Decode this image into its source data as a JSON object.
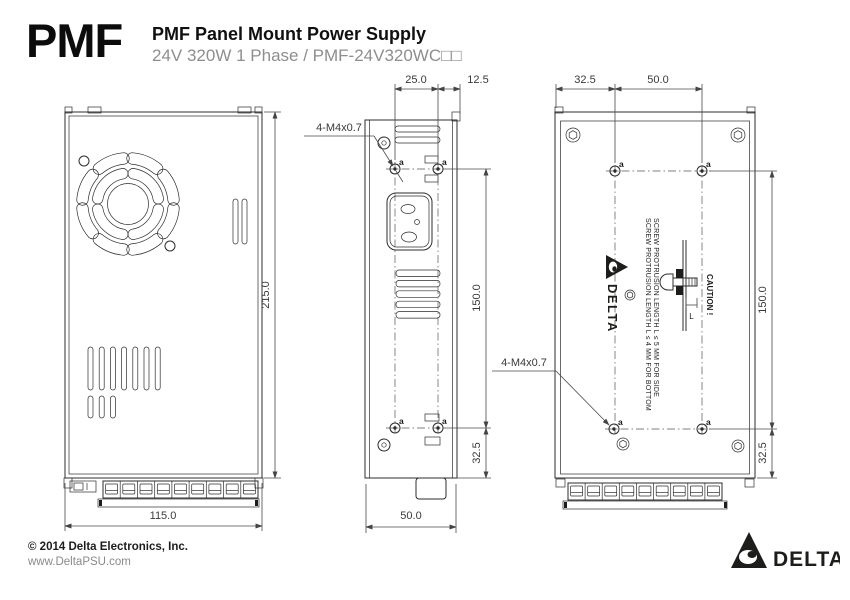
{
  "header": {
    "logo": "PMF",
    "title": "PMF Panel Mount Power Supply",
    "subtitle": "24V 320W 1 Phase / PMF-24V320WC□□"
  },
  "footer": {
    "copyright": "© 2014 Delta Electronics, Inc.",
    "website": "www.DeltaPSU.com",
    "brand": "DELTA"
  },
  "drawing": {
    "front_view": {
      "width": "115.0",
      "height": "215.0"
    },
    "side_view": {
      "hole_pitch": "25.0",
      "hole_edge_offset": "12.5",
      "hole_span": "150.0",
      "hole_bottom_offset": "32.5",
      "depth": "50.0",
      "thread_label": "4-M4x0.7",
      "hole_tag": "a"
    },
    "back_view": {
      "side_offset": "32.5",
      "hole_pitch": "50.0",
      "hole_span": "150.0",
      "hole_bottom_offset": "32.5",
      "thread_label": "4-M4x0.7",
      "hole_tag": "a",
      "caution": "CAUTION !",
      "note_bottom": "SCREW PROTRUSION LENGTH L ≤ 4 MM FOR BOTTOM",
      "note_side": "SCREW PROTRUSION LENGTH L ≤ 5 MM FOR SIDE",
      "screw_length_label": "L",
      "brand": "DELTA"
    }
  },
  "colors": {
    "line": "#2d2d2d",
    "dimension_text": "#3a3a3a",
    "subtitle_gray": "#8e8e8e",
    "ink": "#1d1d1b"
  }
}
